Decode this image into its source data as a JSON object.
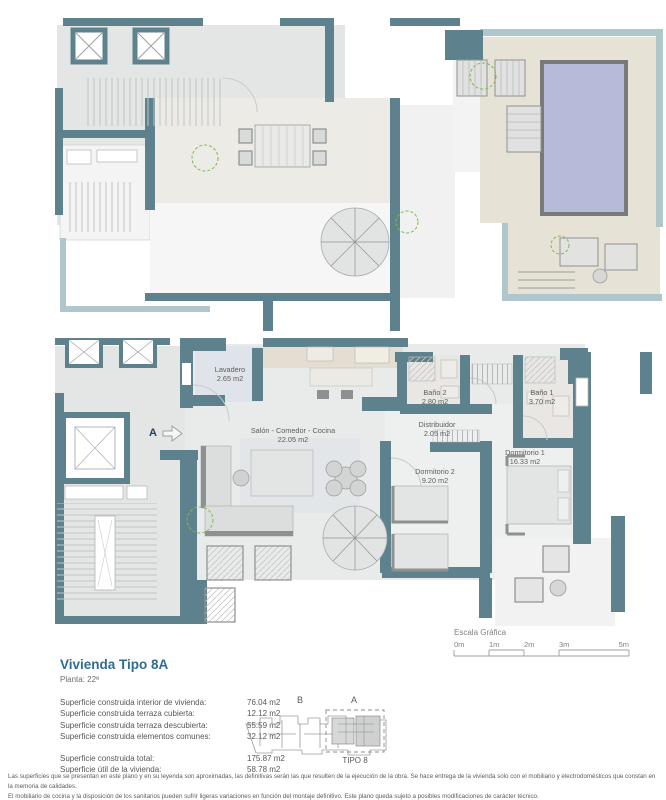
{
  "colors": {
    "wall_teal": "#5e828d",
    "wall_parapet": "#afc7cb",
    "floor_gray": "#e4e6e5",
    "floor_light": "#f3f4f3",
    "terrace_beige": "#e6e3d6",
    "pool_blue": "#b6bbd9",
    "furniture_gray": "#dcdedd",
    "furniture_dark": "#8e918f",
    "plant_green": "#7fba4f",
    "title_blue": "#2e6d90",
    "text_gray": "#58595b"
  },
  "plan_main": {
    "entry_label": "A",
    "rooms": [
      {
        "name": "Lavadero",
        "area": "2.65 m2"
      },
      {
        "name": "Salón - Comedor - Cocina",
        "area": "22.05 m2"
      },
      {
        "name": "Baño 2",
        "area": "2.80 m2"
      },
      {
        "name": "Baño 1",
        "area": "3.70 m2"
      },
      {
        "name": "Distribuidor",
        "area": "2.05 m2"
      },
      {
        "name": "Dormitorio 2",
        "area": "9.20 m2"
      },
      {
        "name": "Dormitorio 1",
        "area": "16.33 m2"
      }
    ]
  },
  "scale_bar": {
    "title": "Escala Gráfica",
    "ticks": [
      "0m",
      "1m",
      "2m",
      "3m",
      "5m"
    ]
  },
  "title_block": {
    "title": "Vivienda Tipo 8A",
    "floor": "Planta: 22ª",
    "areas": [
      {
        "label": "Superficie construida interior de vivienda:",
        "value": "76.04 m2"
      },
      {
        "label": "Superficie construida terraza cubierta:",
        "value": "12.12 m2"
      },
      {
        "label": "Superficie construida terraza descubierta:",
        "value": "55.59 m2"
      },
      {
        "label": "Superficie construida elementos comunes:",
        "value": "32.12 m2"
      }
    ],
    "totals": [
      {
        "label": "Superficie construida total:",
        "value": "175.87 m2"
      },
      {
        "label": "Superficie útil de la vivienda:",
        "value": "58.78 m2"
      }
    ]
  },
  "key_plan": {
    "label_b": "B",
    "label_a": "A",
    "tipo": "TIPO 8"
  },
  "disclaimer": {
    "line1": "Las superficies que se presentan en este plano y en su leyenda son aproximadas, las definitivas serán las que resulten de la ejecución de la obra. Se hace entrega de la vivienda solo con el mobiliario y electrodomésticos que constan en la memoria de calidades.",
    "line2": "El mobiliario de cocina y la disposición de los sanitarios pueden sufrir ligeras variaciones en función del montaje definitivo. Este plano queda sujeto a posibles modificaciones de carácter técnico."
  }
}
